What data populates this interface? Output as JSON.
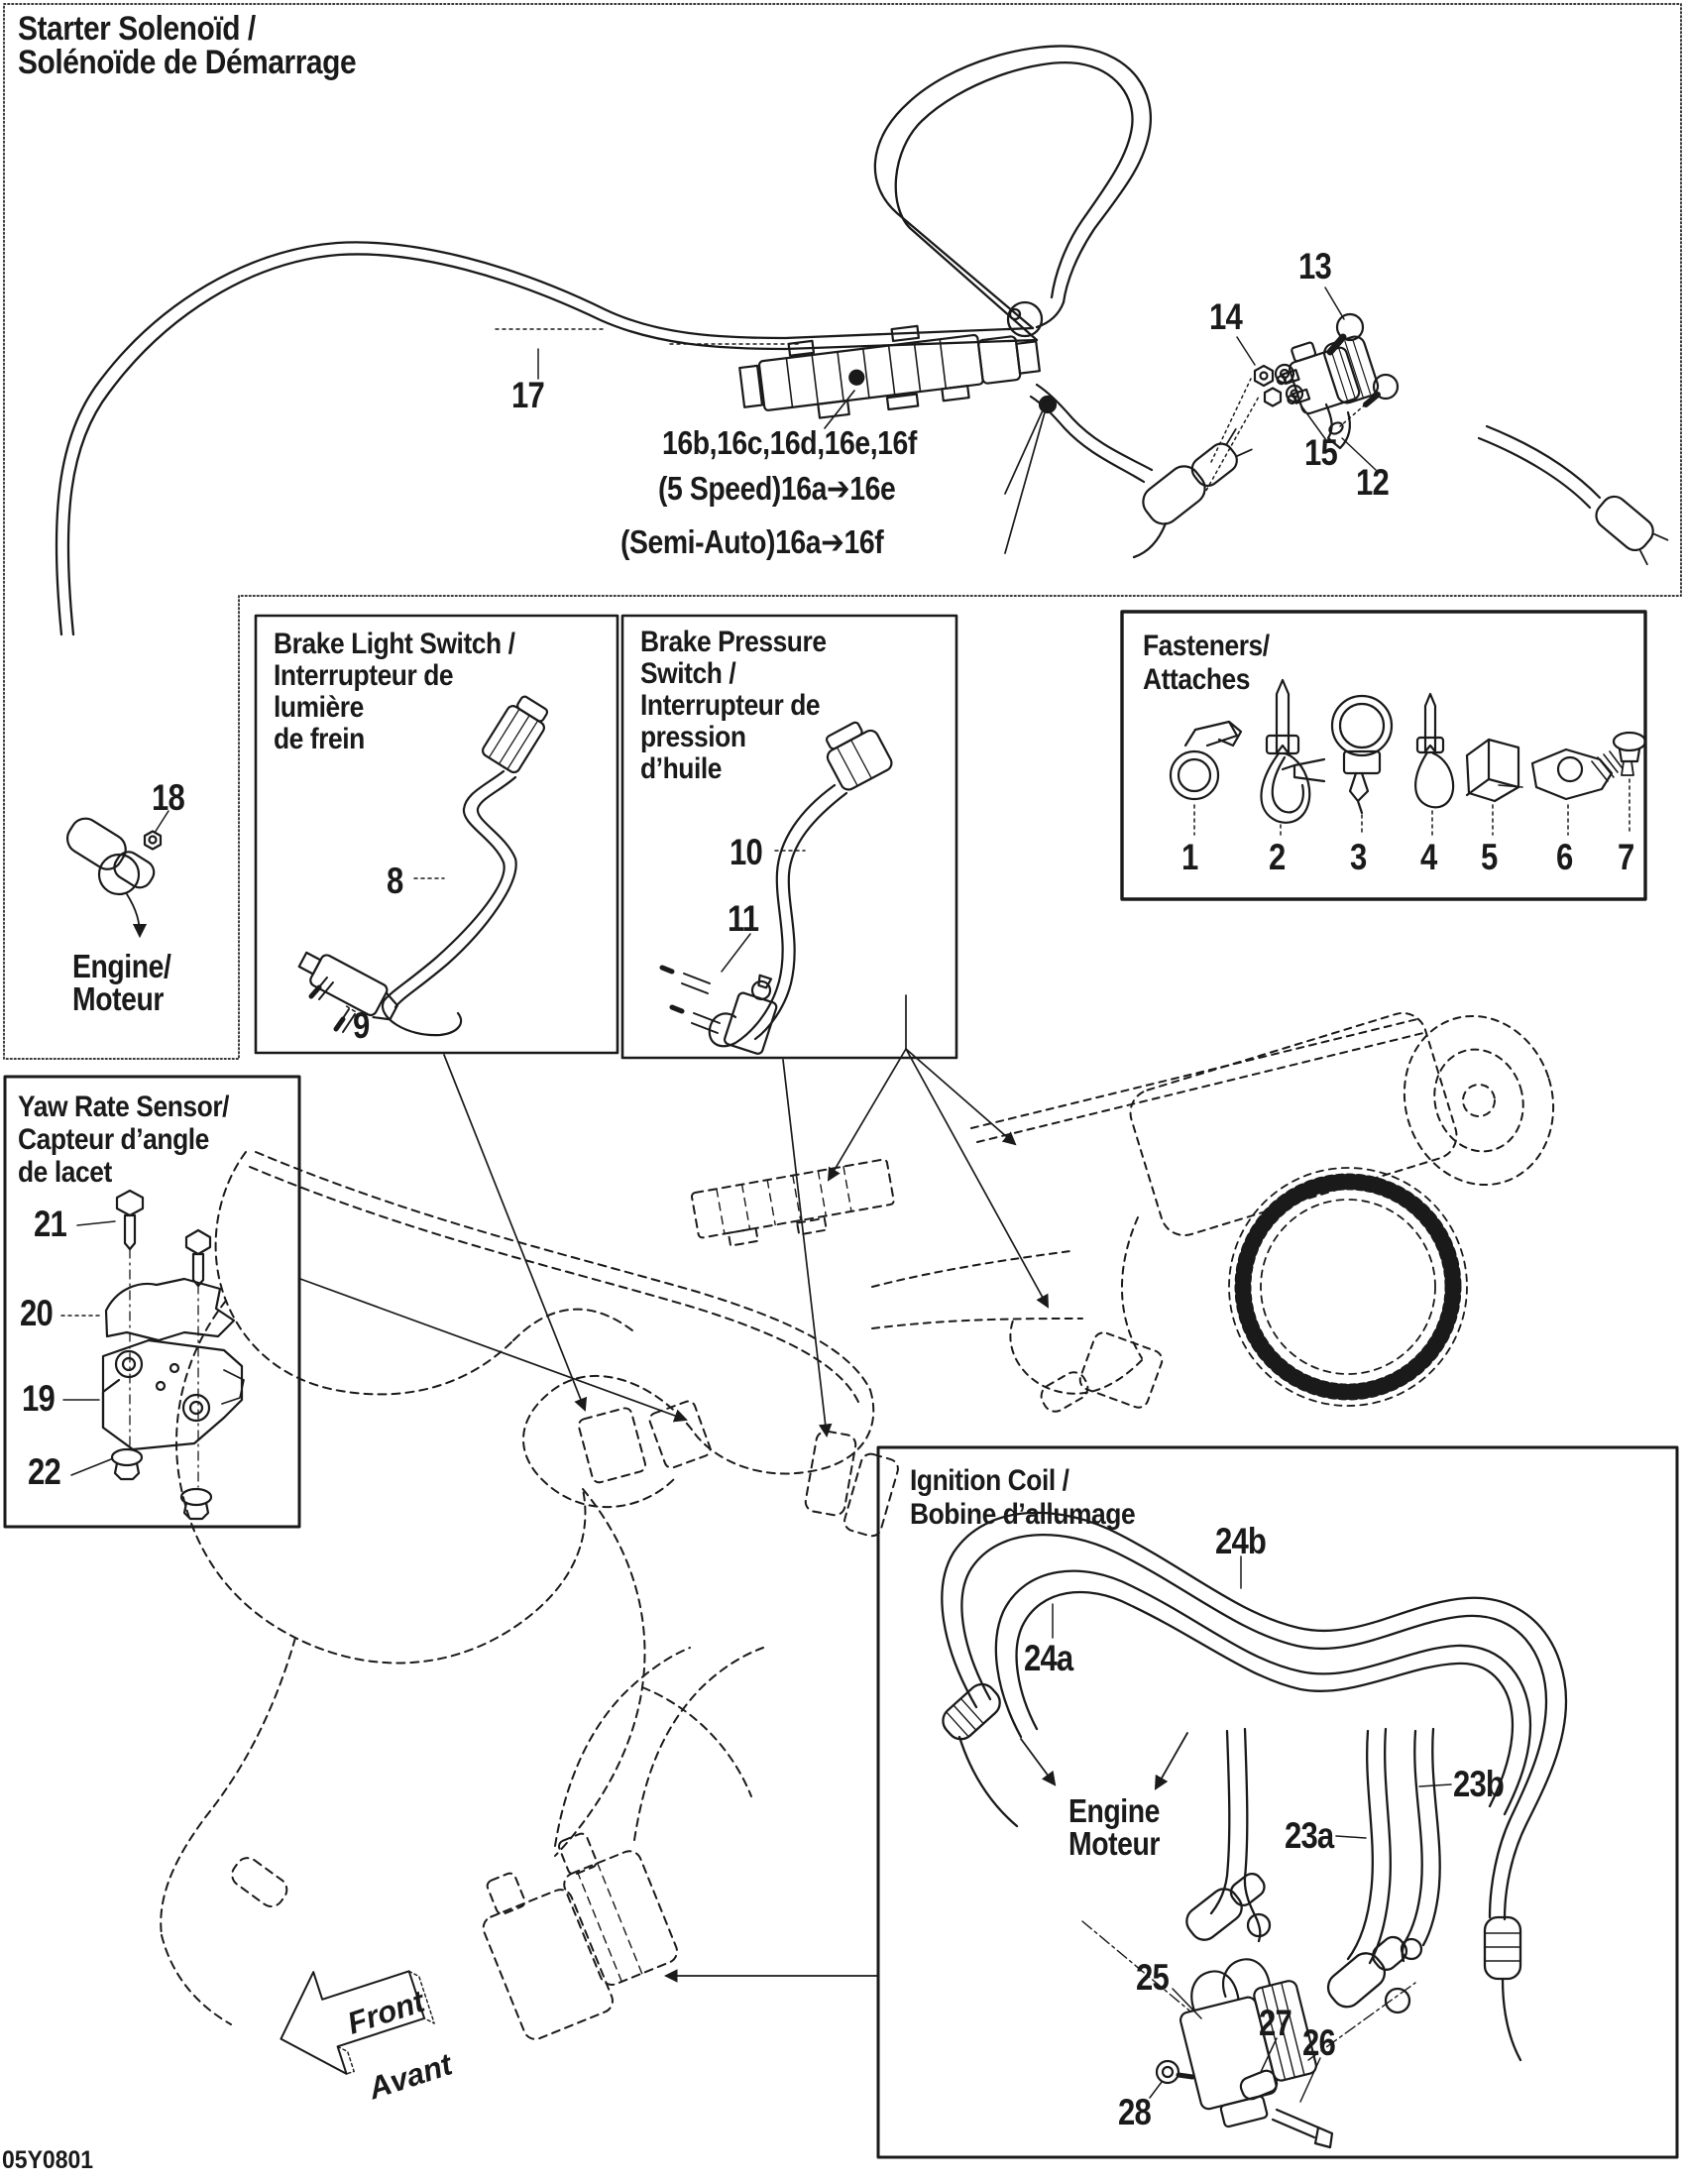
{
  "page": {
    "title_line1": "Starter Solenoïd /",
    "title_line2": "Solénoïde de Démarrage",
    "doc_code": "05Y0801"
  },
  "main_view": {
    "callout_17": "17",
    "callout_16_group": "16b,16c,16d,16e,16f",
    "callout_16_5speed": "(5 Speed)16a➔16e",
    "callout_16_semiauto": "(Semi-Auto)16a➔16f",
    "callout_13": "13",
    "callout_14": "14",
    "callout_15": "15",
    "callout_12": "12",
    "callout_18": "18",
    "engine_label_line1": "Engine/",
    "engine_label_line2": "Moteur"
  },
  "brake_light_box": {
    "title_line1": "Brake Light Switch /",
    "title_line2": "Interrupteur de",
    "title_line3": "lumière",
    "title_line4": "de frein",
    "callout_8": "8",
    "callout_9": "9"
  },
  "brake_pressure_box": {
    "title_line1": "Brake Pressure",
    "title_line2": "Switch /",
    "title_line3": "Interrupteur de",
    "title_line4": "pression",
    "title_line5": "d’huile",
    "callout_10": "10",
    "callout_11": "11"
  },
  "fasteners_box": {
    "title_line1": "Fasteners/",
    "title_line2": "Attaches",
    "items": [
      "1",
      "2",
      "3",
      "4",
      "5",
      "6",
      "7"
    ]
  },
  "yaw_box": {
    "title_line1": "Yaw Rate Sensor/",
    "title_line2": "Capteur d’angle",
    "title_line3": "de lacet",
    "callout_21": "21",
    "callout_20": "20",
    "callout_19": "19",
    "callout_22": "22"
  },
  "ignition_box": {
    "title_line1": "Ignition Coil /",
    "title_line2": "Bobine d’allumage",
    "callout_24b": "24b",
    "callout_24a": "24a",
    "callout_23b": "23b",
    "callout_23a": "23a",
    "engine_label_line1": "Engine",
    "engine_label_line2": "Moteur",
    "callout_25": "25",
    "callout_27": "27",
    "callout_26": "26",
    "callout_28": "28"
  },
  "front_arrow": {
    "line1": "Front",
    "line2": "Avant"
  }
}
